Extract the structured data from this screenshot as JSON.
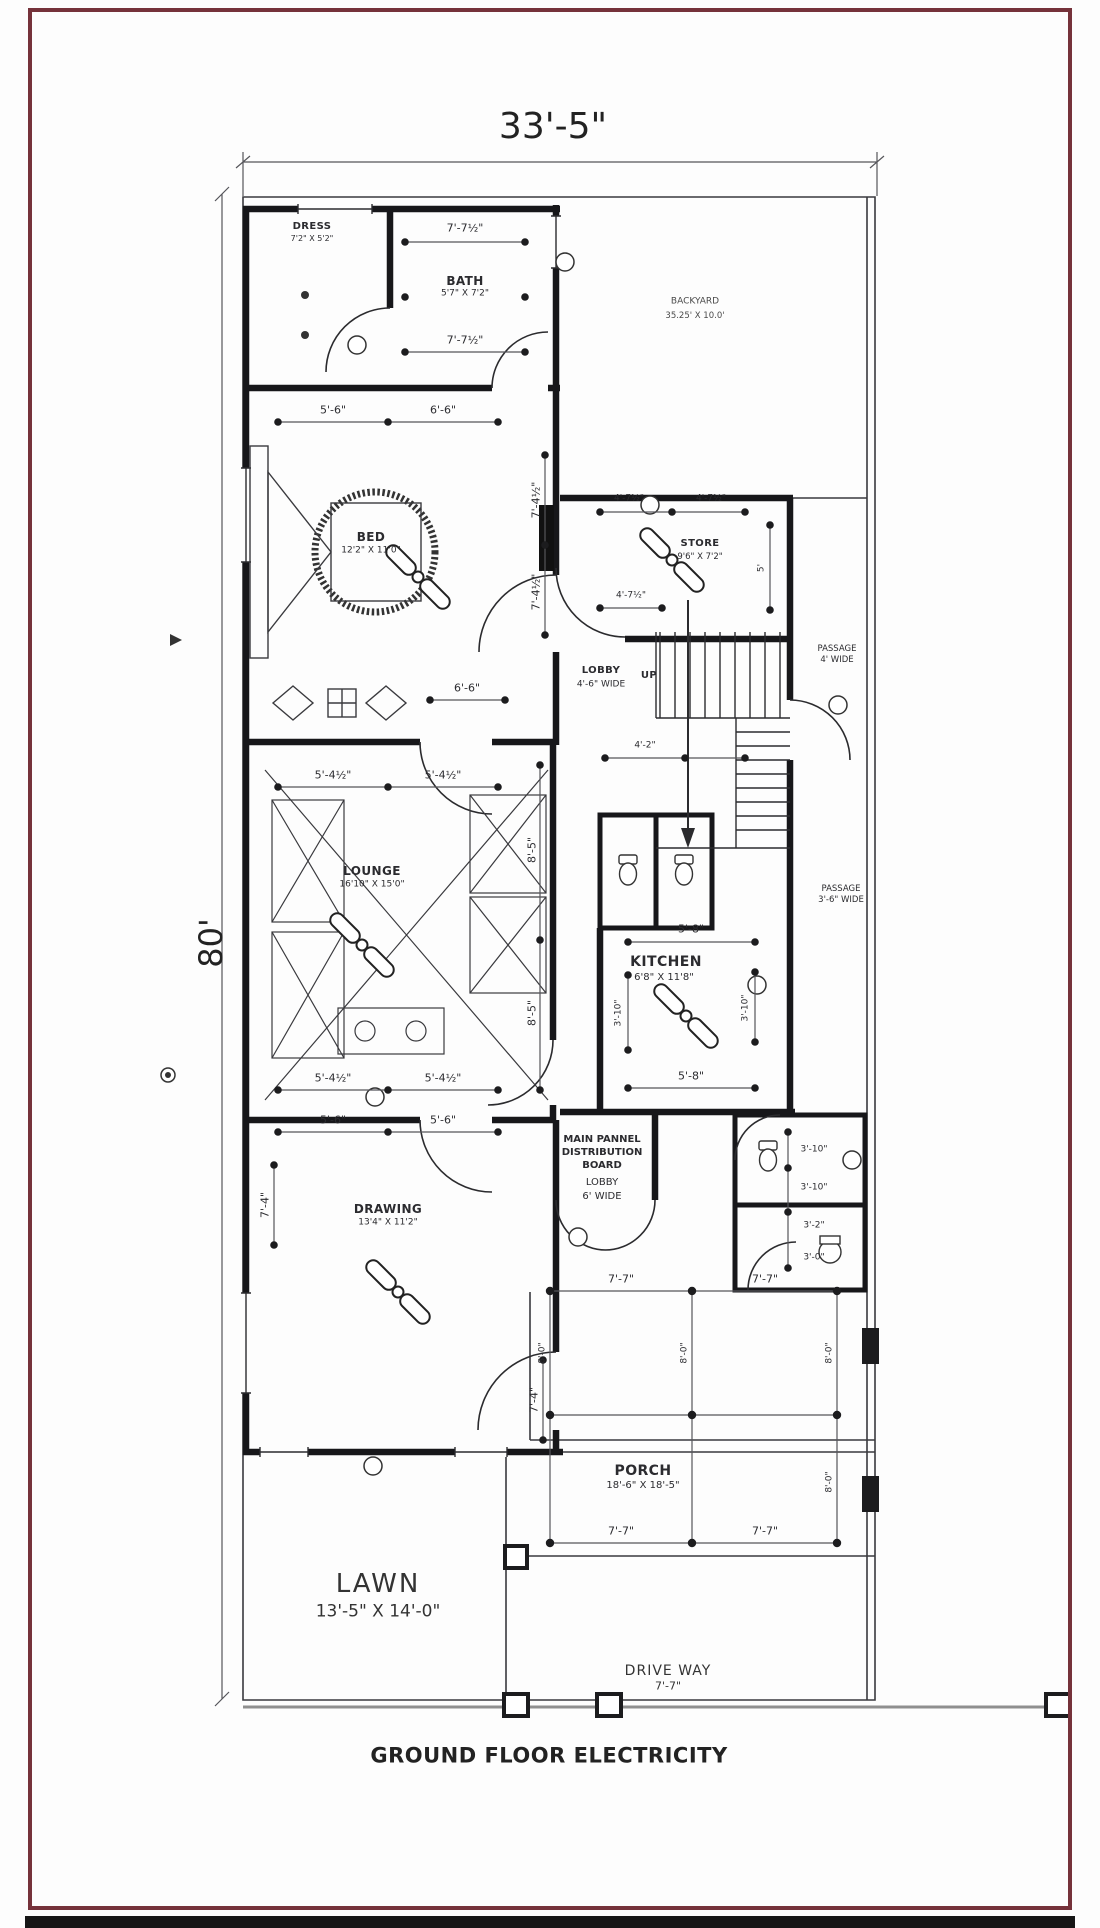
{
  "title": "GROUND FLOOR ELECTRICITY",
  "overall": {
    "width": "33'-5\"",
    "height": "80'"
  },
  "rooms": {
    "dress": {
      "name": "DRESS",
      "size": "7'2\" X 5'2\""
    },
    "bath": {
      "name": "BATH",
      "size": "5'7\" X 7'2\""
    },
    "bed": {
      "name": "BED",
      "size": "12'2\" X 11'0\""
    },
    "store": {
      "name": "STORE",
      "size": "9'6\" X 7'2\""
    },
    "backyard": {
      "name": "BACKYARD",
      "size": "35.25' X 10.0'"
    },
    "lobby1": {
      "name": "LOBBY",
      "size": "4'-6\" WIDE"
    },
    "lounge": {
      "name": "LOUNGE",
      "size": "16'10\" X 15'0\""
    },
    "kitchen": {
      "name": "KITCHEN",
      "size": "6'8\" X 11'8\""
    },
    "drawing": {
      "name": "DRAWING",
      "size": "13'4\" X 11'2\""
    },
    "lobby2": {
      "name": "LOBBY",
      "size": "6' WIDE"
    },
    "porch": {
      "name": "PORCH",
      "size": "18'-6\" X 18'-5\""
    },
    "lawn": {
      "name": "LAWN",
      "size": "13'-5\" X 14'-0\""
    },
    "driveway": {
      "name": "DRIVE WAY",
      "size": "7'-7\""
    },
    "passage1": {
      "name": "PASSAGE",
      "size": "4' WIDE"
    },
    "passage2": {
      "name": "PASSAGE",
      "size": "3'-6\" WIDE"
    }
  },
  "labels": {
    "up": "UP",
    "main_panel_1": "MAIN PANNEL",
    "main_panel_2": "DISTRIBUTION",
    "main_panel_3": "BOARD"
  },
  "dims": {
    "bath_top": "7'-7½\"",
    "bath_bottom": "7'-7½\"",
    "bed_top_left": "5'-6\"",
    "bed_top_right": "6'-6\"",
    "bed_right_1": "7'-4½\"",
    "bed_right_2": "7'-4½\"",
    "bed_door": "6'-6\"",
    "store_top_left": "4'-7½\"",
    "store_top_right": "4'-7½\"",
    "store_bottom": "4'-7½\"",
    "store_right": "5'",
    "hall_top": "4'-2\"",
    "lounge_top_left": "5'-4½\"",
    "lounge_top_right": "5'-4½\"",
    "lounge_bottom_left": "5'-4½\"",
    "lounge_bottom_right": "5'-4½\"",
    "lounge_right_1": "8'-5\"",
    "lounge_right_2": "8'-5\"",
    "kitchen_top": "5'-8\"",
    "kitchen_bottom": "5'-8\"",
    "kitchen_left": "3'-10\"",
    "kitchen_right": "3'-10\"",
    "drawing_top_left": "5'-6\"",
    "drawing_top_right": "5'-6\"",
    "drawing_left": "7'-4\"",
    "drawing_right": "7'-4\"",
    "bath2_1": "3'-10\"",
    "bath2_2": "3'-10\"",
    "bath2_3": "3'-2\"",
    "bath2_4": "3'-0\"",
    "porch_top_left": "7'-7\"",
    "porch_top_right": "7'-7\"",
    "porch_bottom_left": "7'-7\"",
    "porch_bottom_right": "7'-7\"",
    "porch_v1": "8'-0\"",
    "porch_v2": "8'-0\"",
    "porch_v3": "8'-0\"",
    "porch_v4": "8'-0\""
  },
  "colors": {
    "frame": "#75323a",
    "ink": "#1c1c1e"
  }
}
